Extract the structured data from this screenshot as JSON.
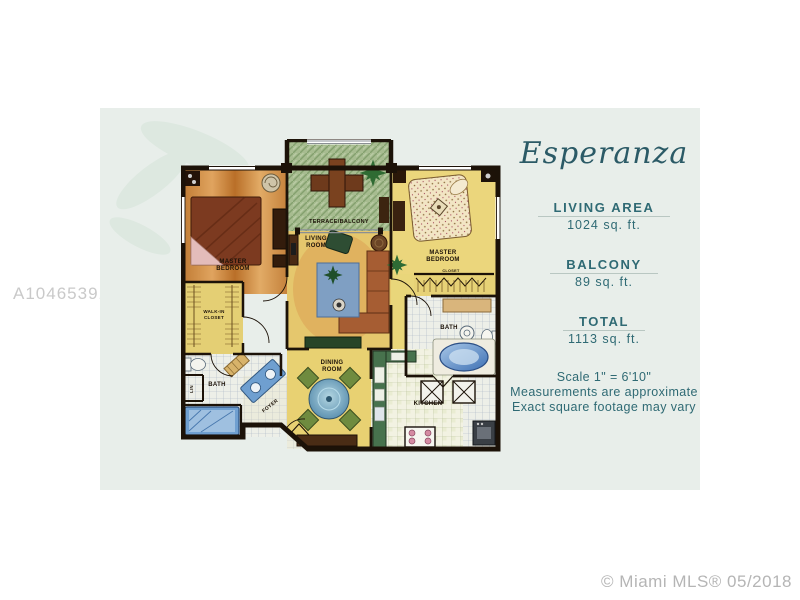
{
  "watermark": {
    "text": "A10465391"
  },
  "footer": {
    "text": "© Miami MLS® 05/2018"
  },
  "panel": {
    "title": "Esperanza",
    "stats": [
      {
        "label": "LIVING AREA",
        "value": "1024 sq. ft."
      },
      {
        "label": "BALCONY",
        "value": "89 sq. ft."
      },
      {
        "label": "TOTAL",
        "value": "1113 sq. ft."
      }
    ],
    "notes": [
      "Scale 1\" = 6'10\"",
      "Measurements are approximate",
      "Exact square footage may vary"
    ]
  },
  "floorplan": {
    "rooms": {
      "master_left": {
        "line1": "MASTER",
        "line2": "BEDROOM"
      },
      "terrace": {
        "label": "TERRACE/BALCONY"
      },
      "living": {
        "line1": "LIVING",
        "line2": "ROOM"
      },
      "master_right": {
        "line1": "MASTER",
        "line2": "BEDROOM"
      },
      "closet_right": {
        "label": "CLOSET"
      },
      "bath_right": {
        "label": "BATH"
      },
      "kitchen": {
        "label": "KITCHEN"
      },
      "dining": {
        "line1": "DINING",
        "line2": "ROOM"
      },
      "bath_left": {
        "label": "BATH"
      },
      "walkin": {
        "line1": "WALK-IN",
        "line2": "CLOSET"
      },
      "lin": {
        "label": "LIN"
      },
      "foyer": {
        "label": "FOYER"
      }
    }
  },
  "colors": {
    "card_bg": "#e8eeea",
    "accent_teal": "#2f6a74",
    "title_teal": "#2b5a66",
    "wall_black": "#1c1208",
    "floor_yellow": "#e8d172",
    "floor_orange": "#cd8a42",
    "terrace_green": "#a7bc90",
    "counter_green": "#47724d",
    "water_blue": "#6f9fd0",
    "wood_brown": "#7c3a20",
    "watermark_gray": "#c9c9c9"
  }
}
